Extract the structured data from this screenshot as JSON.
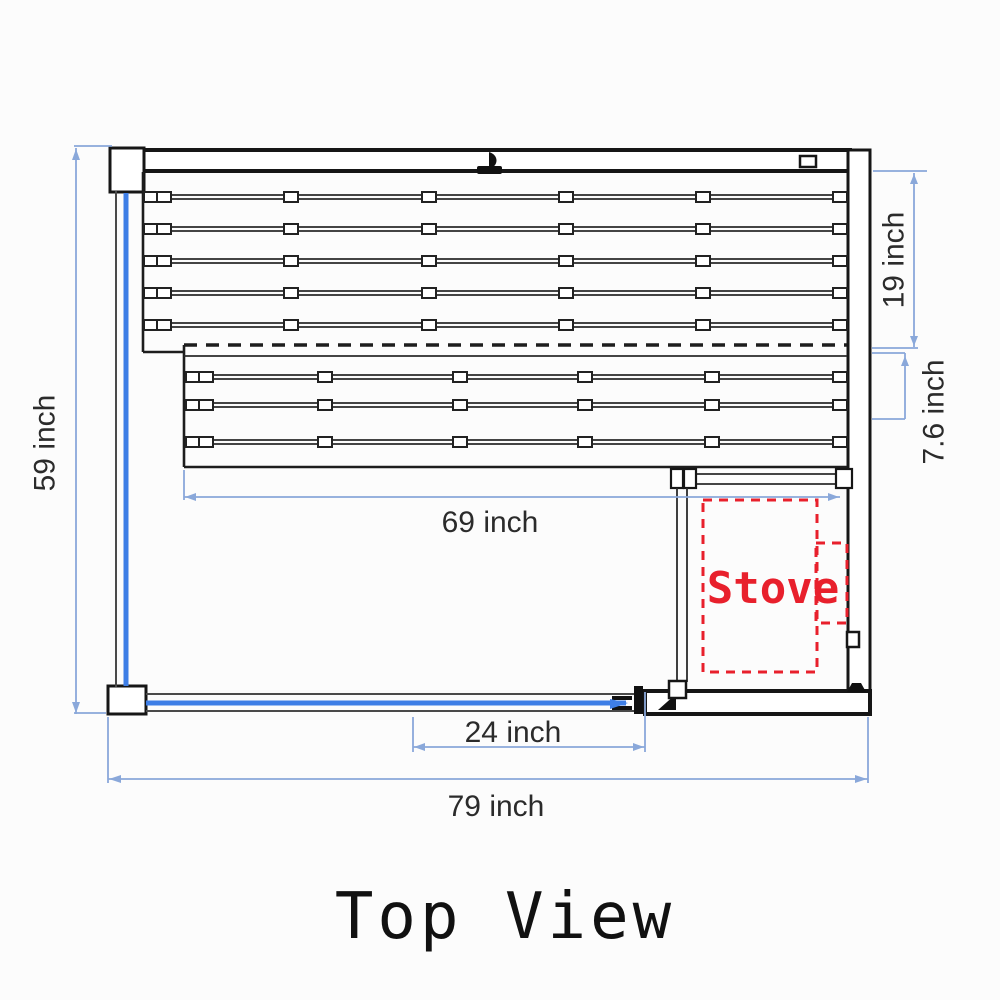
{
  "diagram": {
    "title": "Top View",
    "dimensions": {
      "total_width": "79 inch",
      "total_depth": "59 inch",
      "lower_bench_length": "69 inch",
      "door_width": "24 inch",
      "upper_bench_depth": "19 inch",
      "lower_bench_front_depth": "7.6 inch"
    },
    "stove_label": "Stove",
    "colors": {
      "dimension_line": "#8aa8da",
      "glass_panel": "#3e7ee6",
      "stove_outline": "#e8202c",
      "wall_line": "#161616"
    }
  }
}
